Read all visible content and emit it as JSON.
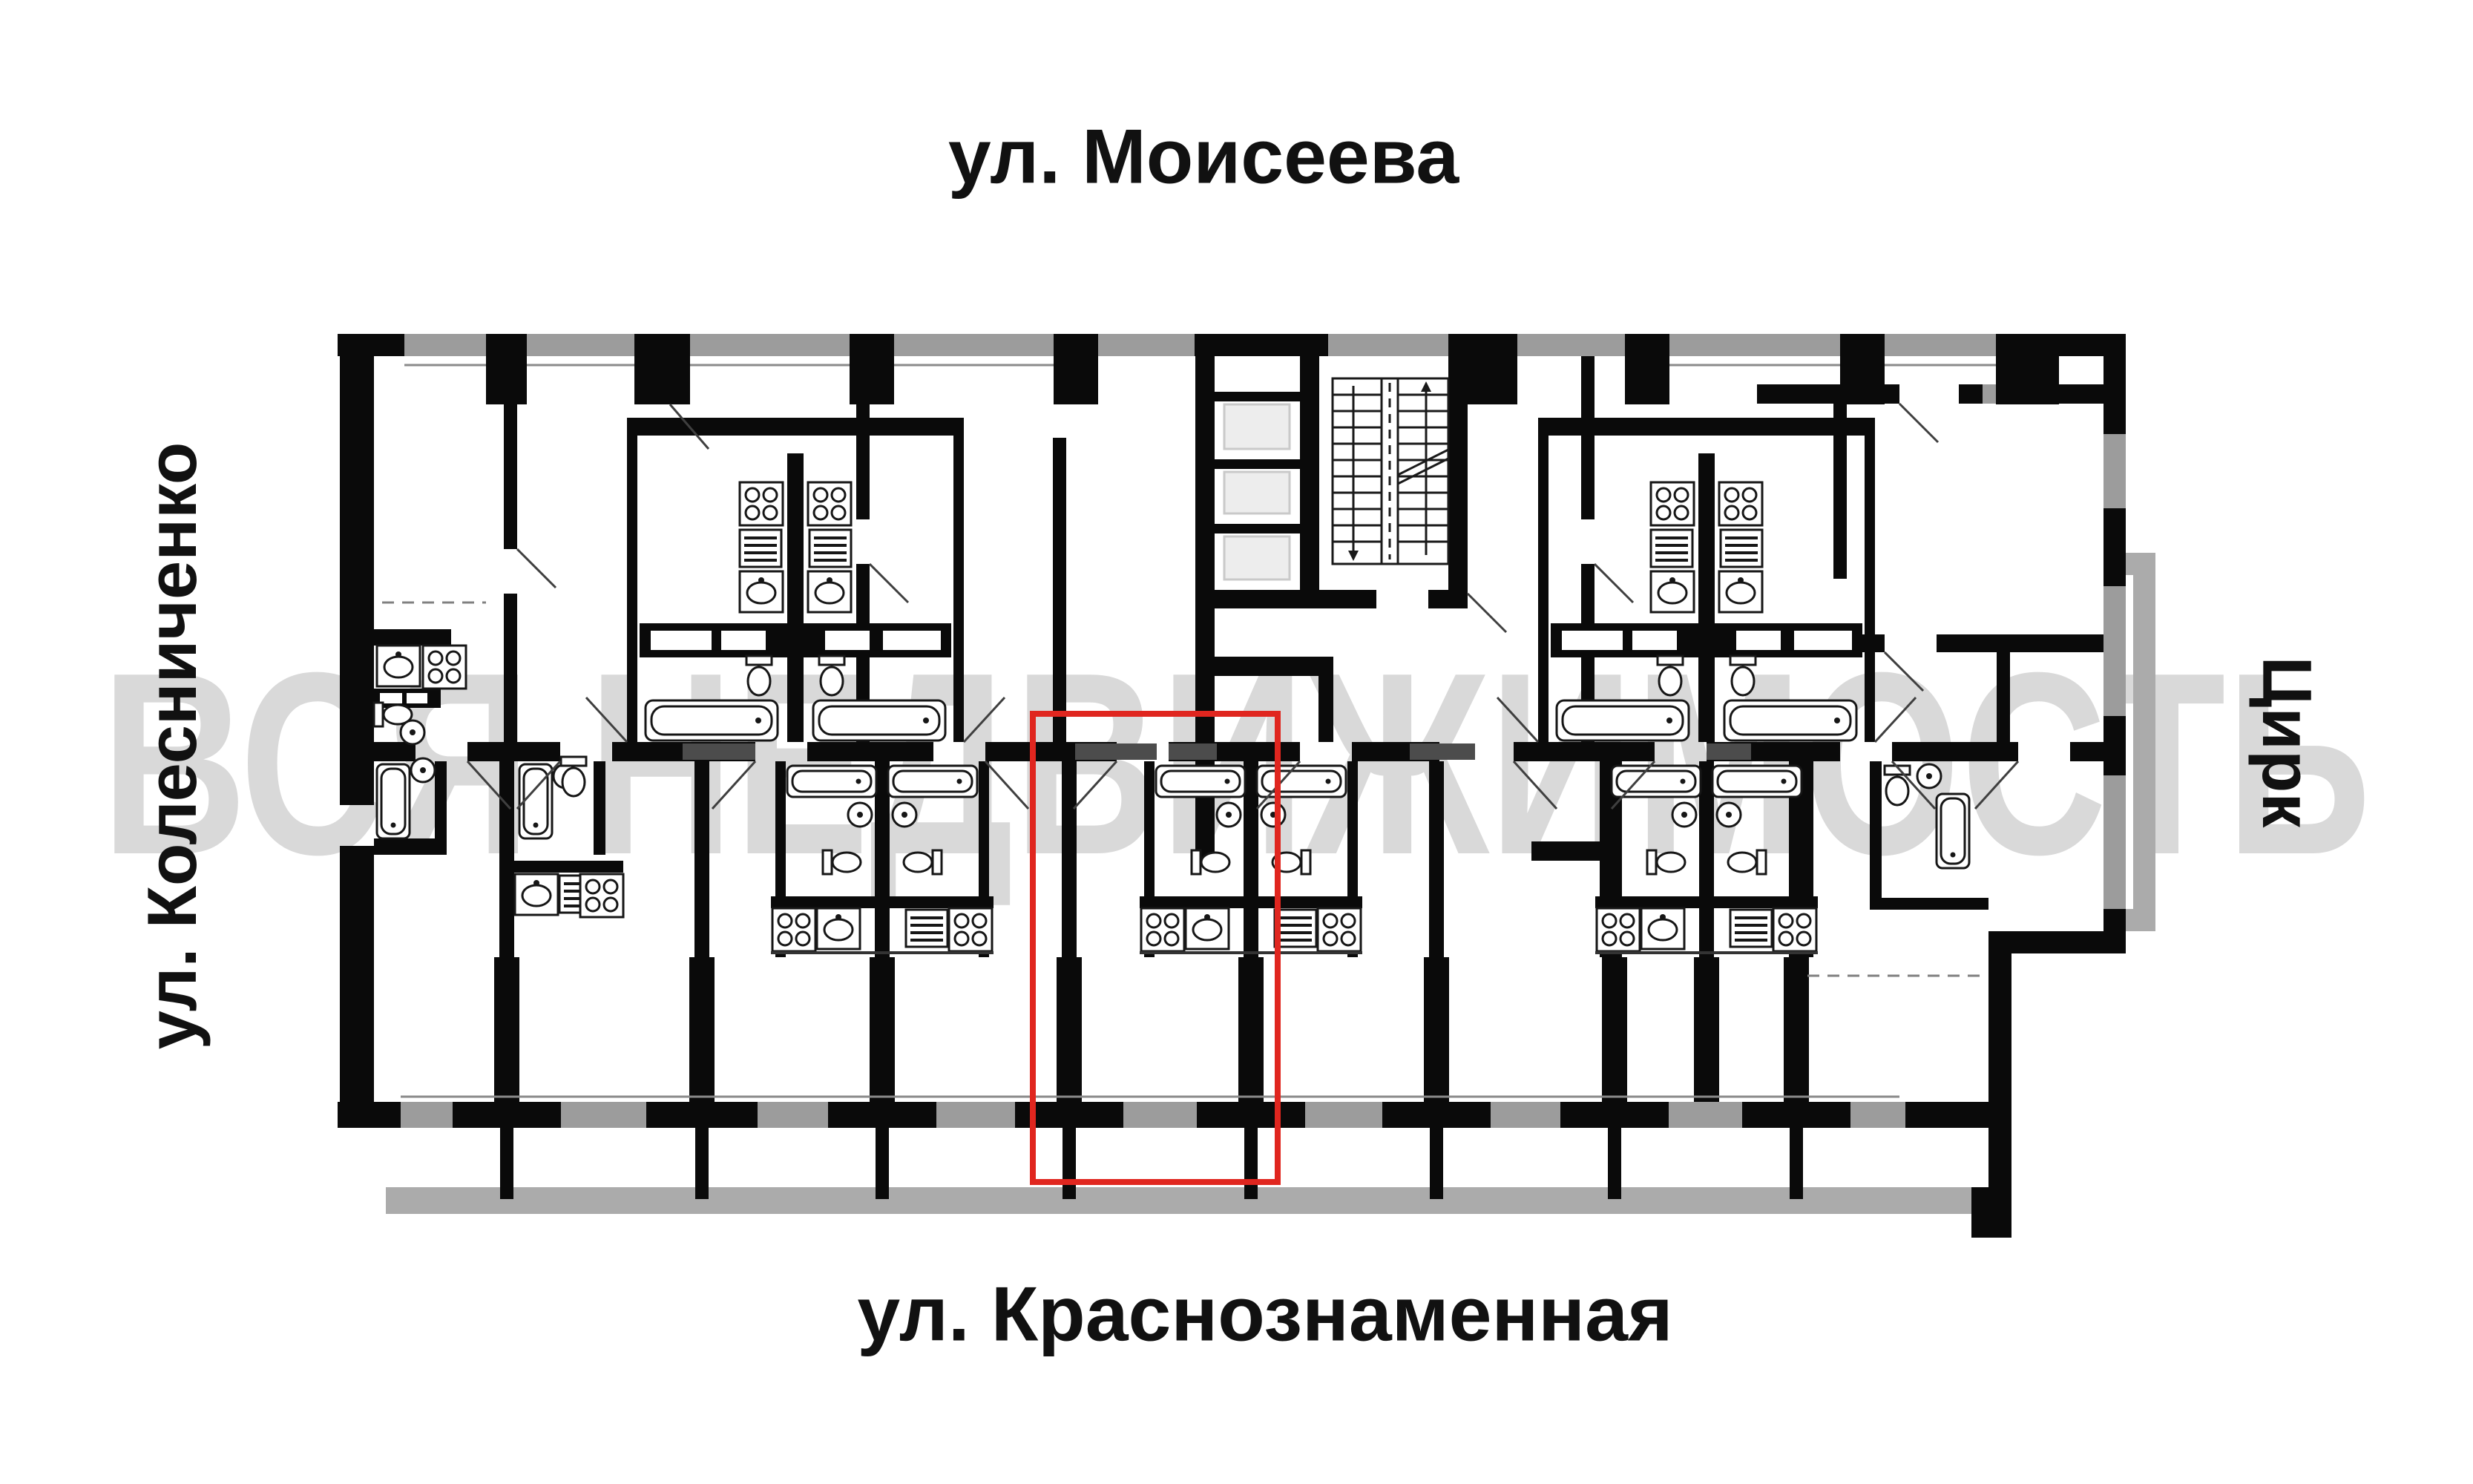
{
  "labels": {
    "top": "ул. Моисеева",
    "left": "ул. Колесниченко",
    "right": "Цирк",
    "bottom": "ул. Краснознаменная"
  },
  "watermark": {
    "text": "ВСЯ НЕДВИЖИМОСТЬ",
    "color": "#d9d9d9"
  },
  "highlight": {
    "color": "#e0261f"
  },
  "colors": {
    "wall": "#0a0a0a",
    "window": "#9c9c9c",
    "balcony": "#ababab",
    "partial_wall": "#4c4c4c",
    "elevator_fill": "#ededed",
    "elevator_stroke": "#c9c9c9"
  }
}
